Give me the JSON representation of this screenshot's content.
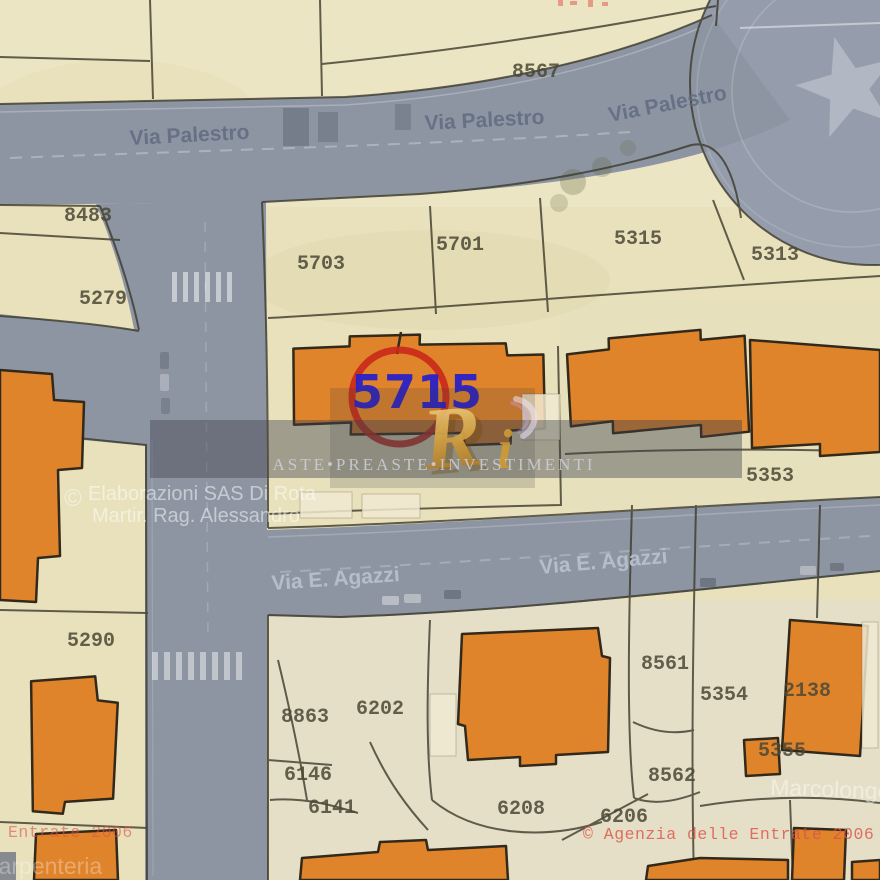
{
  "streets": [
    {
      "id": "palestro-left",
      "text": "Via Palestro"
    },
    {
      "id": "palestro-center",
      "text": "Via Palestro"
    },
    {
      "id": "palestro-right",
      "text": "Via Palestro"
    },
    {
      "id": "agazzi-left",
      "text": "Via E. Agazzi"
    },
    {
      "id": "agazzi-right",
      "text": "Via E. Agazzi"
    }
  ],
  "parcels": [
    {
      "number": "8567"
    },
    {
      "number": "8483"
    },
    {
      "number": "5279"
    },
    {
      "number": "5703"
    },
    {
      "number": "5701"
    },
    {
      "number": "5315"
    },
    {
      "number": "5313"
    },
    {
      "number": "5353"
    },
    {
      "number": "5290"
    },
    {
      "number": "8863"
    },
    {
      "number": "6202"
    },
    {
      "number": "6146"
    },
    {
      "number": "6141"
    },
    {
      "number": "6208"
    },
    {
      "number": "8561"
    },
    {
      "number": "5354"
    },
    {
      "number": "2138"
    },
    {
      "number": "8562"
    },
    {
      "number": "5355"
    },
    {
      "number": "6206"
    }
  ],
  "highlight": {
    "parcel_number": "5715"
  },
  "area_labels": {
    "marcolongo": "Marcolongo",
    "carpenteria": "Carpenteria"
  },
  "watermarks": {
    "brand": {
      "monogram_large": "R",
      "monogram_small": "i",
      "band_text": "Aste•Preaste•Investimenti"
    },
    "credit": {
      "symbol": "©",
      "line1": "Elaborazioni SAS Di Rota",
      "line2": "Martir. Rag. Alessandro"
    },
    "agency": {
      "stamp": "© Agenzia delle Entrate 2006",
      "stamp_partial": "Entrate 2006"
    }
  },
  "colors": {
    "parcel_bg": "#e8e1bc",
    "road": "#8d95a3",
    "roundabout": "#959dac",
    "building": "#e0842c",
    "building_outline": "#33291a",
    "boundary": "#3c3a2a",
    "highlight_circle": "#c9281a",
    "highlight_number": "#2a21c8",
    "stamp_red": "#dd5148",
    "street_label_dark": "#5e6980",
    "street_label_light": "#bac1ce",
    "parcel_label": "#4b4836",
    "watermark_gold": "#cf9a34"
  }
}
